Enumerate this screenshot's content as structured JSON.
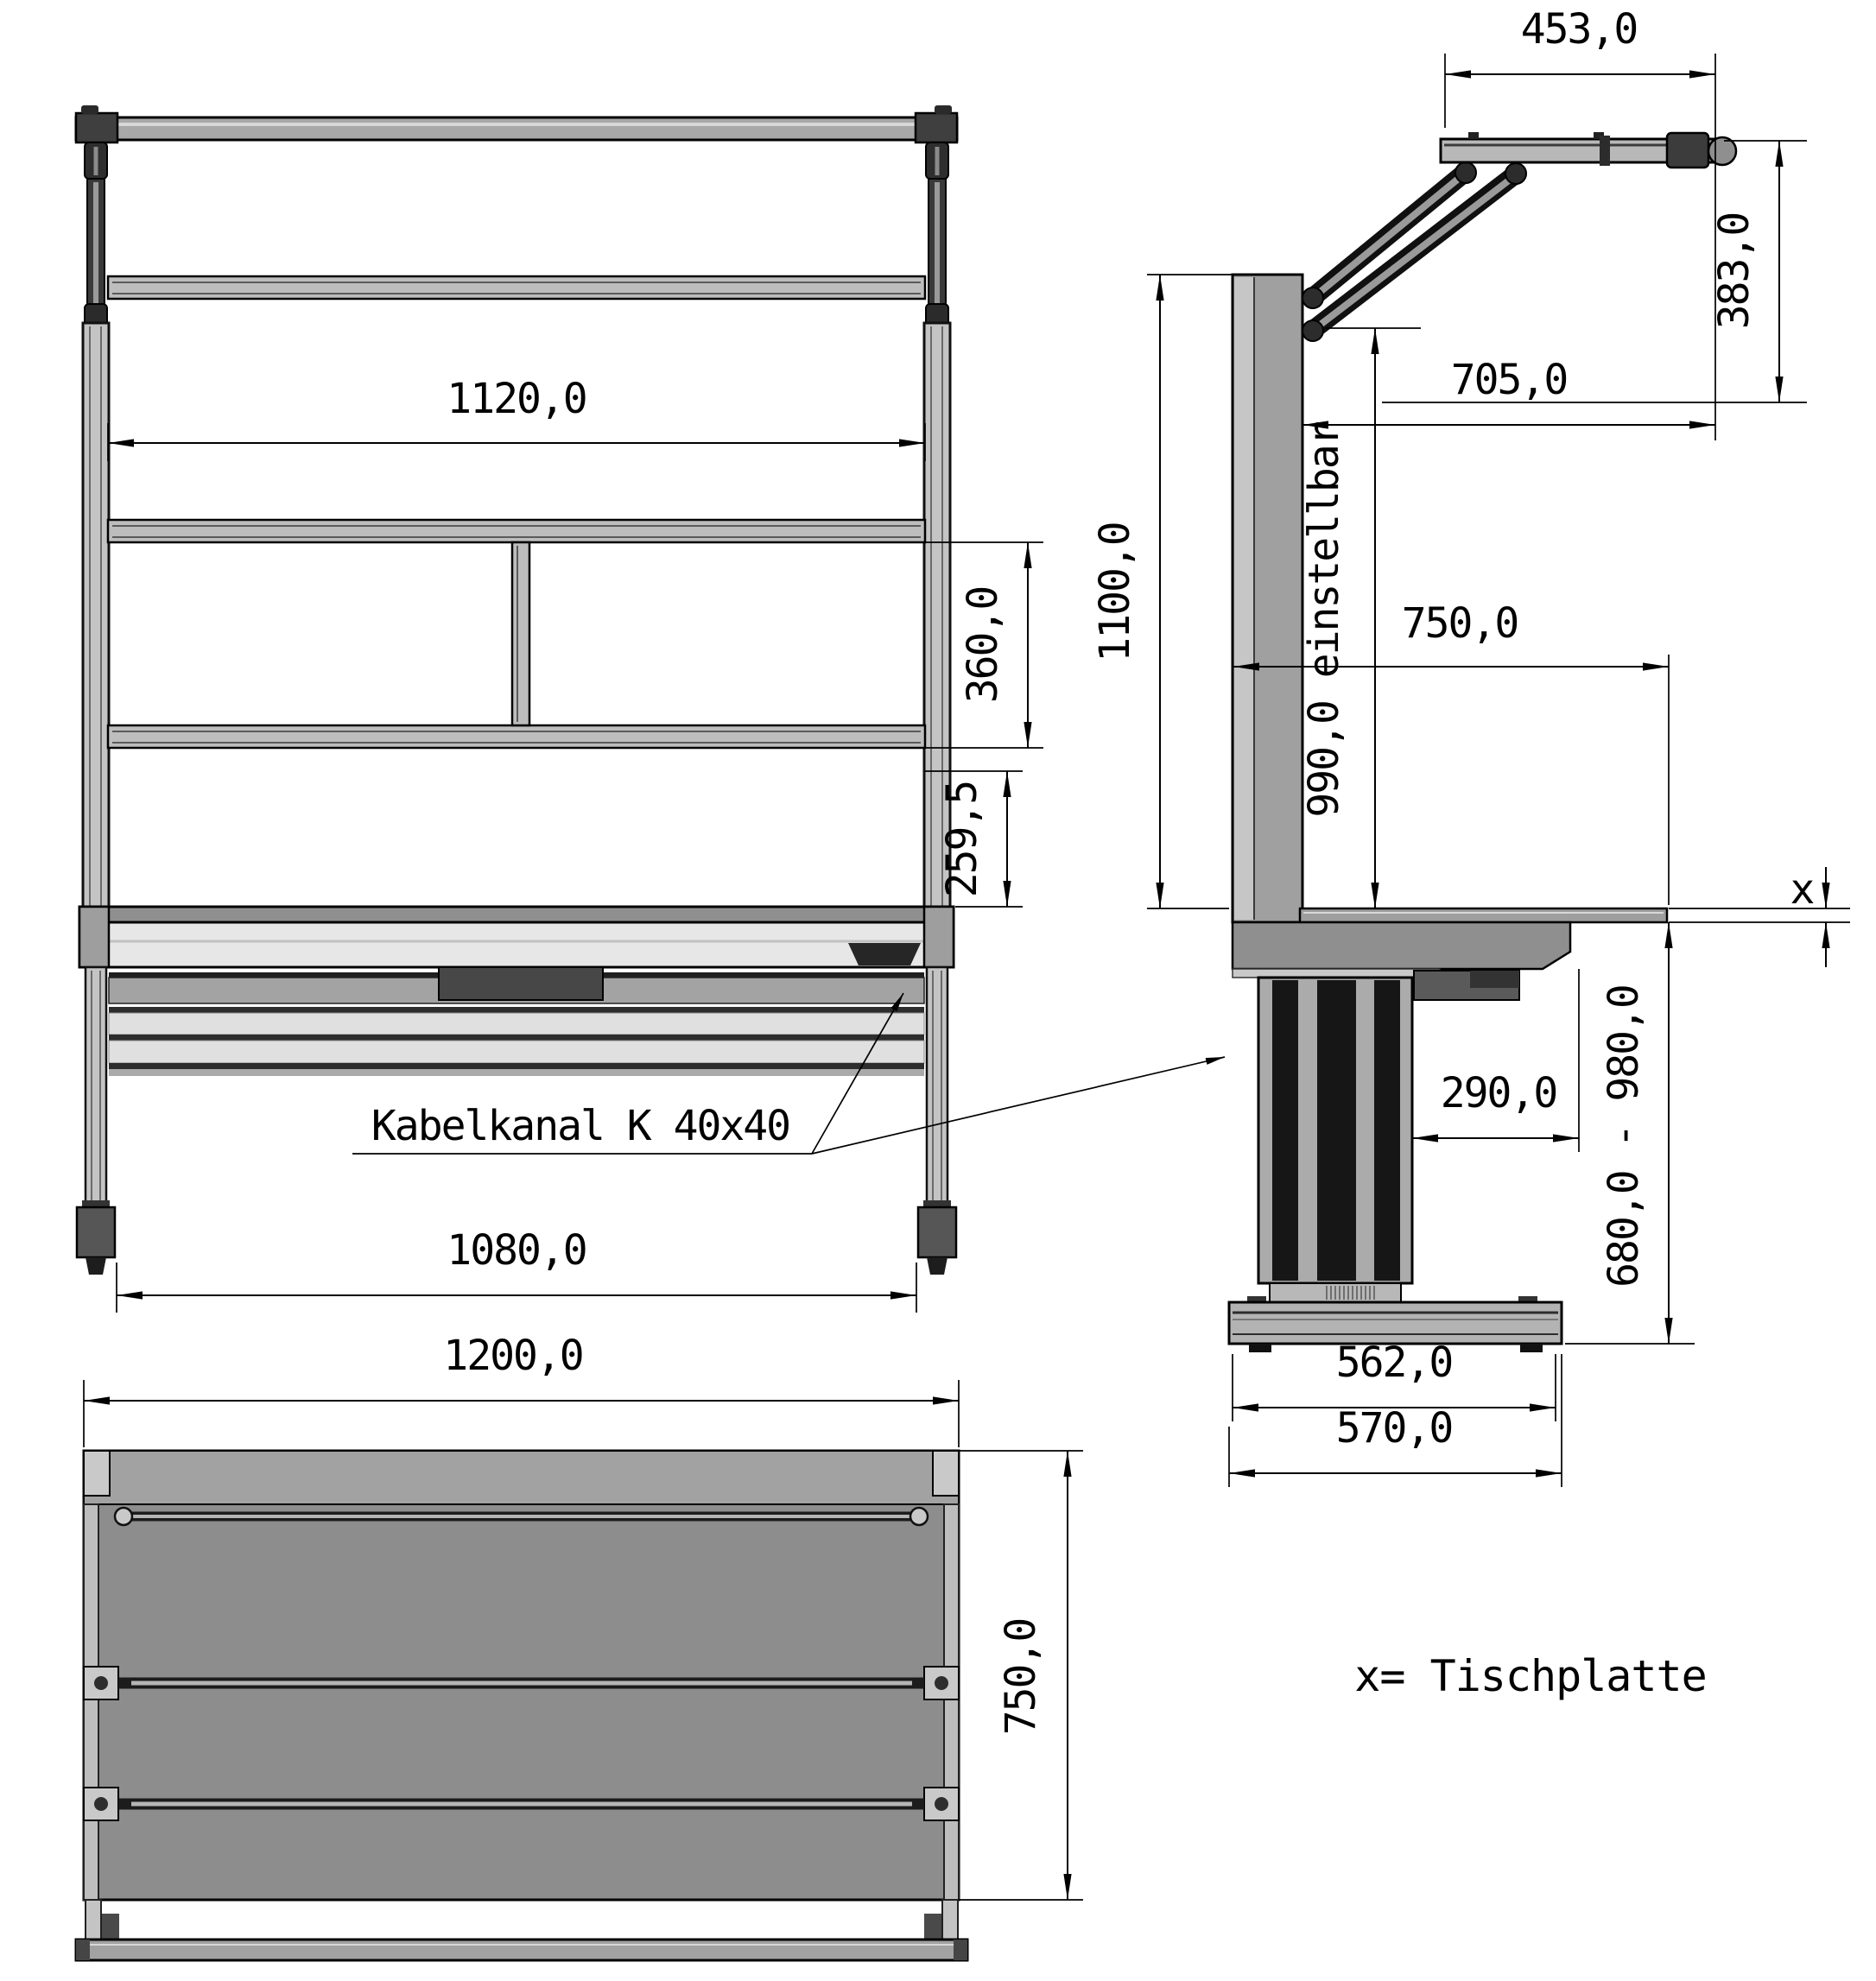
{
  "colors": {
    "background": "#ffffff",
    "outline": "#000000",
    "gray_light": "#e7e7e7",
    "gray_mid": "#a2a2a2",
    "gray_surface": "#8d8d8d",
    "gray_dark": "#3c3c3c"
  },
  "front_view": {
    "dim_inner_width": "1120,0",
    "dim_shelf_spacing": "360,0",
    "dim_lower_gap": "259,5",
    "dim_feet_span": "1080,0",
    "dim_total_width": "1200,0",
    "cable_duct_label": "Kabelkanal K 40x40"
  },
  "side_view": {
    "dim_arm_length": "453,0",
    "dim_arm_height": "383,0",
    "dim_arm_reach": "705,0",
    "dim_frame_height": "1100,0",
    "dim_adjustable": "990,0 einstellbar",
    "dim_table_depth": "750,0",
    "dim_column_offset": "290,0",
    "dim_height_range": "680,0 - 980,0",
    "dim_base_length": "562,0",
    "dim_base_overall": "570,0",
    "tabletop_marker": "x"
  },
  "top_view": {
    "dim_depth": "750,0"
  },
  "legend": {
    "tabletop_note": "x= Tischplatte"
  }
}
